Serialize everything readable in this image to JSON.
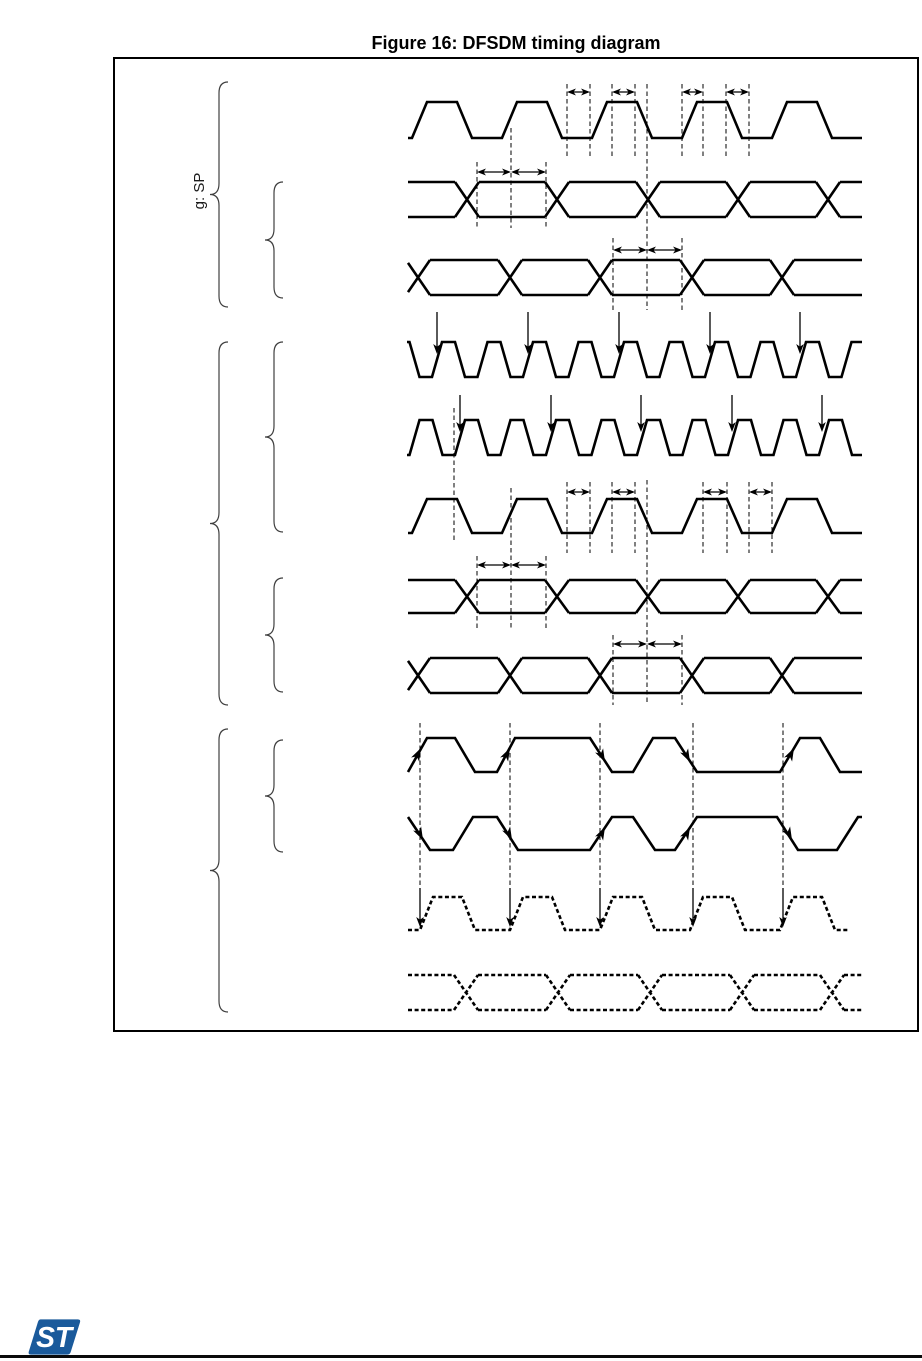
{
  "figure": {
    "title": "Figure 16: DFSDM timing diagram",
    "rotated_label": "g: SP"
  },
  "logo": {
    "label": "ST",
    "color": "#1A5A9B"
  },
  "colors": {
    "ink": "#000000",
    "brace": "#3f3f3f"
  },
  "diagram": {
    "box": {
      "x": 113,
      "y": 57,
      "w": 806,
      "h": 975
    },
    "braces": [
      {
        "name": "brace-group-1",
        "x": 228,
        "y0": 82,
        "y1": 307
      },
      {
        "name": "brace-group-1-sub",
        "x": 283,
        "y0": 182,
        "y1": 298
      },
      {
        "name": "brace-group-2",
        "x": 228,
        "y0": 342,
        "y1": 705
      },
      {
        "name": "brace-group-2-sub-a",
        "x": 283,
        "y0": 342,
        "y1": 532
      },
      {
        "name": "brace-group-2-sub-b",
        "x": 283,
        "y0": 578,
        "y1": 692
      },
      {
        "name": "brace-group-3",
        "x": 228,
        "y0": 729,
        "y1": 1012
      },
      {
        "name": "brace-group-3-sub",
        "x": 283,
        "y0": 740,
        "y1": 852
      }
    ],
    "rows": [
      {
        "name": "waveform-clock-1",
        "kind": "clock",
        "x0": 408,
        "x1": 862,
        "yHigh": 102,
        "yLow": 138,
        "period": 90,
        "edge": 15,
        "high": 30,
        "riseAt": 412,
        "dashed": false
      },
      {
        "name": "waveform-data-1",
        "kind": "bus",
        "x0": 408,
        "x1": 862,
        "yTop": 182,
        "yBottom": 217,
        "xw": 12,
        "centers": [
          467,
          557,
          648,
          738,
          828
        ],
        "dashed": false
      },
      {
        "name": "waveform-data-2",
        "kind": "bus",
        "x0": 408,
        "x1": 862,
        "yTop": 260,
        "yBottom": 295,
        "xw": 12,
        "centers": [
          418,
          510,
          600,
          692,
          782
        ],
        "dashed": false
      },
      {
        "name": "waveform-fast-clock-1",
        "kind": "clock",
        "x0": 407,
        "x1": 862,
        "yHigh": 342,
        "yLow": 377,
        "period": 45.5,
        "edge": 10,
        "high": 13,
        "riseAt": 432,
        "dashed": false
      },
      {
        "name": "waveform-fast-clock-2",
        "kind": "clock",
        "x0": 407,
        "x1": 862,
        "yHigh": 420,
        "yLow": 455,
        "period": 45.5,
        "edge": 10,
        "high": 13,
        "riseAt": 455,
        "dashed": false
      },
      {
        "name": "waveform-clock-2",
        "kind": "clock",
        "x0": 408,
        "x1": 862,
        "yHigh": 499,
        "yLow": 533,
        "period": 90,
        "edge": 15,
        "high": 30,
        "riseAt": 412,
        "dashed": false
      },
      {
        "name": "waveform-data-3",
        "kind": "bus",
        "x0": 408,
        "x1": 862,
        "yTop": 580,
        "yBottom": 613,
        "xw": 12,
        "centers": [
          467,
          557,
          648,
          738,
          828
        ],
        "dashed": false
      },
      {
        "name": "waveform-data-4",
        "kind": "bus",
        "x0": 408,
        "x1": 862,
        "yTop": 658,
        "yBottom": 693,
        "xw": 12,
        "centers": [
          418,
          510,
          600,
          692,
          782
        ],
        "dashed": false
      },
      {
        "name": "waveform-manchester-1",
        "kind": "poly",
        "dashed": false,
        "points": [
          [
            408,
            772
          ],
          [
            427,
            738
          ],
          [
            455,
            738
          ],
          [
            475,
            772
          ],
          [
            497,
            772
          ],
          [
            515,
            738
          ],
          [
            590,
            738
          ],
          [
            612,
            772
          ],
          [
            633,
            772
          ],
          [
            653,
            738
          ],
          [
            675,
            738
          ],
          [
            697,
            772
          ],
          [
            780,
            772
          ],
          [
            800,
            738
          ],
          [
            820,
            738
          ],
          [
            840,
            772
          ],
          [
            862,
            772
          ]
        ]
      },
      {
        "name": "waveform-manchester-2",
        "kind": "poly",
        "dashed": false,
        "points": [
          [
            408,
            817
          ],
          [
            430,
            850
          ],
          [
            453,
            850
          ],
          [
            473,
            817
          ],
          [
            497,
            817
          ],
          [
            518,
            850
          ],
          [
            590,
            850
          ],
          [
            612,
            817
          ],
          [
            633,
            817
          ],
          [
            655,
            850
          ],
          [
            675,
            850
          ],
          [
            697,
            817
          ],
          [
            777,
            817
          ],
          [
            798,
            850
          ],
          [
            837,
            850
          ],
          [
            858,
            817
          ],
          [
            862,
            817
          ]
        ]
      },
      {
        "name": "waveform-recovered-clock",
        "kind": "clock",
        "x0": 408,
        "x1": 848,
        "yHigh": 897,
        "yLow": 930,
        "period": 90,
        "edge": 13,
        "high": 29,
        "riseAt": 420,
        "dashed": true
      },
      {
        "name": "waveform-recovered-data",
        "kind": "bus",
        "x0": 408,
        "x1": 862,
        "yTop": 975,
        "yBottom": 1010,
        "xw": 12,
        "centers": [
          466,
          558,
          650,
          742,
          832
        ],
        "dashed": true
      }
    ],
    "vlines": [
      {
        "x": 567,
        "y0": 84,
        "y1": 156
      },
      {
        "x": 590,
        "y0": 84,
        "y1": 156
      },
      {
        "x": 612,
        "y0": 84,
        "y1": 156
      },
      {
        "x": 635,
        "y0": 84,
        "y1": 156
      },
      {
        "x": 682,
        "y0": 84,
        "y1": 156
      },
      {
        "x": 703,
        "y0": 84,
        "y1": 156
      },
      {
        "x": 726,
        "y0": 84,
        "y1": 156
      },
      {
        "x": 749,
        "y0": 84,
        "y1": 156
      },
      {
        "x": 511,
        "y0": 128,
        "y1": 228
      },
      {
        "x": 647,
        "y0": 84,
        "y1": 310
      },
      {
        "x": 477,
        "y0": 162,
        "y1": 228
      },
      {
        "x": 546,
        "y0": 162,
        "y1": 228
      },
      {
        "x": 613,
        "y0": 238,
        "y1": 310
      },
      {
        "x": 682,
        "y0": 238,
        "y1": 310
      },
      {
        "x": 454,
        "y0": 408,
        "y1": 542
      },
      {
        "x": 567,
        "y0": 482,
        "y1": 553
      },
      {
        "x": 590,
        "y0": 482,
        "y1": 553
      },
      {
        "x": 612,
        "y0": 482,
        "y1": 553
      },
      {
        "x": 635,
        "y0": 482,
        "y1": 553
      },
      {
        "x": 703,
        "y0": 482,
        "y1": 553
      },
      {
        "x": 727,
        "y0": 482,
        "y1": 553
      },
      {
        "x": 749,
        "y0": 482,
        "y1": 553
      },
      {
        "x": 772,
        "y0": 482,
        "y1": 553
      },
      {
        "x": 511,
        "y0": 488,
        "y1": 628
      },
      {
        "x": 647,
        "y0": 480,
        "y1": 705
      },
      {
        "x": 477,
        "y0": 556,
        "y1": 628
      },
      {
        "x": 546,
        "y0": 556,
        "y1": 628
      },
      {
        "x": 613,
        "y0": 635,
        "y1": 705
      },
      {
        "x": 682,
        "y0": 635,
        "y1": 705
      },
      {
        "x": 420,
        "y0": 723,
        "y1": 886
      },
      {
        "x": 510,
        "y0": 723,
        "y1": 886
      },
      {
        "x": 600,
        "y0": 723,
        "y1": 886
      },
      {
        "x": 693,
        "y0": 723,
        "y1": 886
      },
      {
        "x": 783,
        "y0": 723,
        "y1": 886
      }
    ],
    "harrows": [
      {
        "x0": 567,
        "x1": 590,
        "y": 92
      },
      {
        "x0": 612,
        "x1": 635,
        "y": 92
      },
      {
        "x0": 682,
        "x1": 703,
        "y": 92
      },
      {
        "x0": 726,
        "x1": 749,
        "y": 92
      },
      {
        "x0": 477,
        "x1": 511,
        "y": 172
      },
      {
        "x0": 511,
        "x1": 546,
        "y": 172
      },
      {
        "x0": 613,
        "x1": 647,
        "y": 250
      },
      {
        "x0": 647,
        "x1": 682,
        "y": 250
      },
      {
        "x0": 567,
        "x1": 590,
        "y": 492
      },
      {
        "x0": 612,
        "x1": 635,
        "y": 492
      },
      {
        "x0": 703,
        "x1": 727,
        "y": 492
      },
      {
        "x0": 749,
        "x1": 772,
        "y": 492
      },
      {
        "x0": 477,
        "x1": 511,
        "y": 565
      },
      {
        "x0": 511,
        "x1": 546,
        "y": 565
      },
      {
        "x0": 613,
        "x1": 647,
        "y": 644
      },
      {
        "x0": 647,
        "x1": 682,
        "y": 644
      }
    ],
    "varrows": [
      {
        "x": 437,
        "y0": 312,
        "y1": 354
      },
      {
        "x": 528,
        "y0": 312,
        "y1": 354
      },
      {
        "x": 619,
        "y0": 312,
        "y1": 354
      },
      {
        "x": 710,
        "y0": 312,
        "y1": 354
      },
      {
        "x": 800,
        "y0": 312,
        "y1": 354
      },
      {
        "x": 460,
        "y0": 395,
        "y1": 432
      },
      {
        "x": 551,
        "y0": 395,
        "y1": 432
      },
      {
        "x": 641,
        "y0": 395,
        "y1": 432
      },
      {
        "x": 732,
        "y0": 395,
        "y1": 432
      },
      {
        "x": 822,
        "y0": 395,
        "y1": 432
      },
      {
        "x": 420,
        "y0": 888,
        "y1": 927
      },
      {
        "x": 510,
        "y0": 888,
        "y1": 927
      },
      {
        "x": 600,
        "y0": 888,
        "y1": 927
      },
      {
        "x": 693,
        "y0": 888,
        "y1": 927
      },
      {
        "x": 783,
        "y0": 888,
        "y1": 927
      }
    ],
    "edge_arrows": [
      {
        "x": 421,
        "y": 748,
        "dir": "ne"
      },
      {
        "x": 510,
        "y": 748,
        "dir": "ne"
      },
      {
        "x": 605,
        "y": 762,
        "dir": "se"
      },
      {
        "x": 690,
        "y": 762,
        "dir": "se"
      },
      {
        "x": 794,
        "y": 748,
        "dir": "ne"
      },
      {
        "x": 423,
        "y": 840,
        "dir": "se"
      },
      {
        "x": 512,
        "y": 840,
        "dir": "se"
      },
      {
        "x": 605,
        "y": 827,
        "dir": "ne"
      },
      {
        "x": 690,
        "y": 827,
        "dir": "ne"
      },
      {
        "x": 792,
        "y": 840,
        "dir": "se"
      }
    ]
  }
}
